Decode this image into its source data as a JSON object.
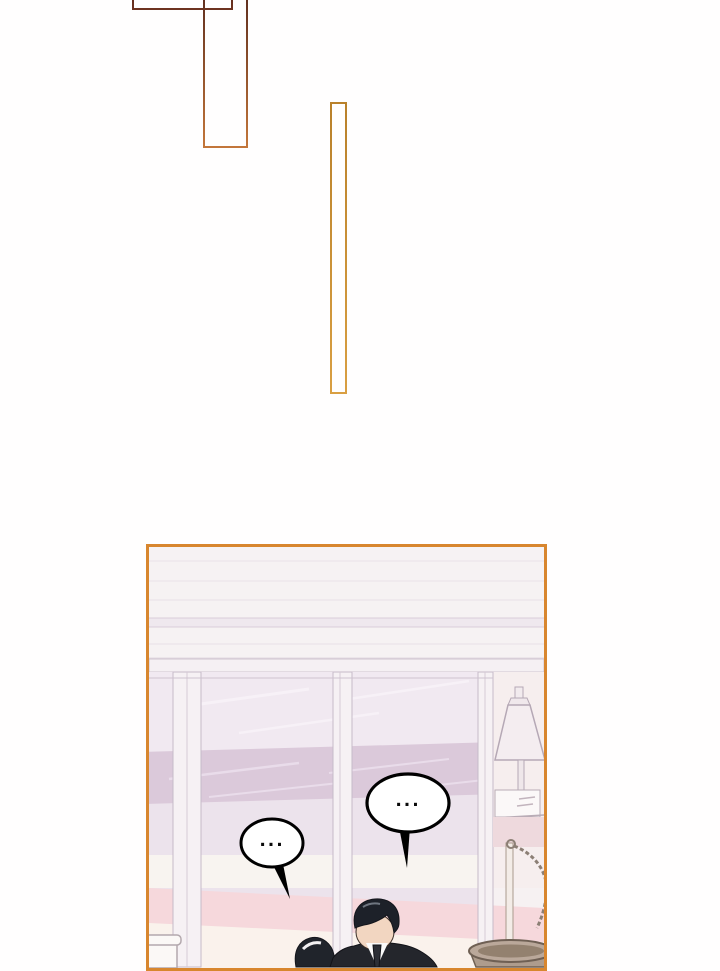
{
  "page": {
    "kind": "webtoon comic page",
    "background_color": "#fffefe"
  },
  "colors": {
    "panel_border": "#d8862e",
    "decor_dark_brown": "#50241b",
    "decor_orange": "#c3763a",
    "decor_gold": "#c9922f",
    "wall": "#f6f1f2",
    "glass": "#ece3ec",
    "glass_band_purple": "#dbc9da",
    "floor_pink": "#f6d8dc",
    "hair_black": "#1d2129",
    "skin": "#f2d6c1",
    "suit_black": "#24262c",
    "bubble_fill": "#ffffff",
    "bubble_stroke": "#000000"
  },
  "decor_rectangles": [
    {
      "label": "top-left horizontal outline, cut off by top edge"
    },
    {
      "label": "top vertical outline, cut off by top edge"
    },
    {
      "label": "middle thin vertical gold outline"
    }
  ],
  "panel": {
    "description": "interior doorway scene with two silent speech bubbles, a suited man, a bowing figure, lamp, chain and planter",
    "speech_bubbles": [
      {
        "text": "...",
        "position": "left"
      },
      {
        "text": "...",
        "position": "upper-right"
      }
    ]
  }
}
